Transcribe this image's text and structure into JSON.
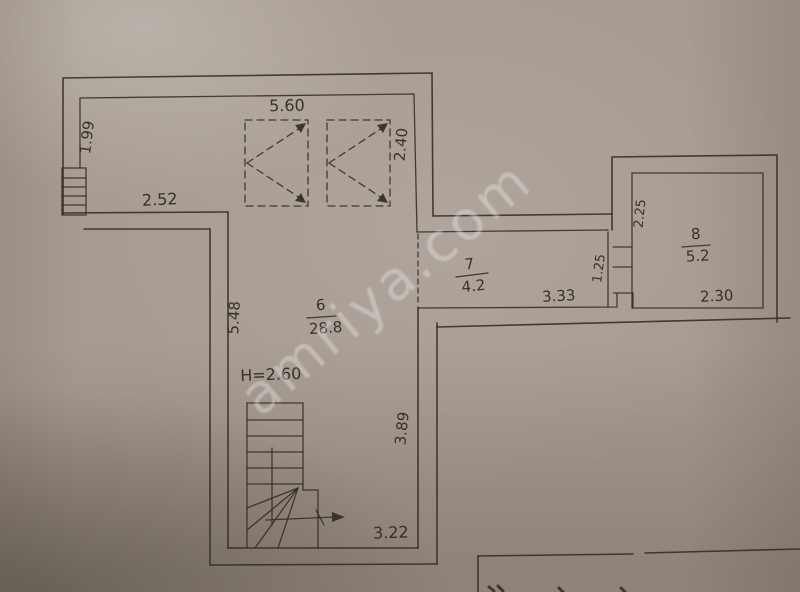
{
  "watermark": "amriya.com",
  "plan": {
    "type": "floor-plan-photo",
    "rooms": {
      "room6": {
        "number": "6",
        "area": "28.8",
        "height_note": "H=2.60"
      },
      "room7": {
        "number": "7",
        "area": "4.2"
      },
      "room8": {
        "number": "8",
        "area": "5.2"
      }
    },
    "dimensions": {
      "top_width": "5.60",
      "left_upper_height": "1.99",
      "right_upper_height": "2.40",
      "left_wall_width": "2.52",
      "room6_west_height": "5.48",
      "room6_east_height": "3.89",
      "room6_bottom_width": "3.22",
      "corridor_length": "3.33",
      "corridor_width": "1.25",
      "room8_height": "2.25",
      "room8_width": "2.30"
    },
    "colors": {
      "ink": "#332c26",
      "paper": "#a69b91"
    }
  }
}
